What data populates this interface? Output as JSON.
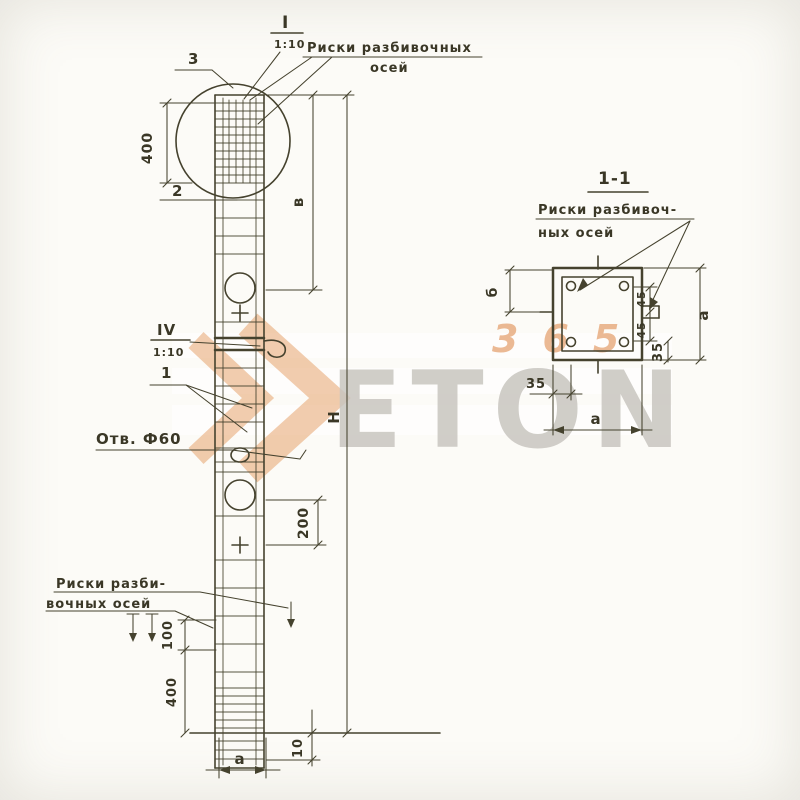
{
  "palette": {
    "ink": "#45422e",
    "orange": "#dd8340",
    "letters_gray": "#c9c6c0"
  },
  "elevation": {
    "callout_top": "3",
    "callout_upper": "2",
    "callout_mid": "1",
    "detail_top": {
      "numeral": "I",
      "scale": "1:10"
    },
    "detail_mid": {
      "numeral": "IV",
      "scale": "1:10"
    },
    "riski_top": {
      "line1": "Риски разбивочных",
      "line2": "осей"
    },
    "riski_bottom": {
      "line1": "Риски разби-",
      "line2": "вочных осей"
    },
    "hole_label": "Отв. Ф60",
    "dim_top_400": "400",
    "dim_v": "в",
    "dim_H": "Н",
    "dim_200": "200",
    "dim_100": "100",
    "dim_bottom_400": "400",
    "dim_width_a": "а",
    "dim_10": "10"
  },
  "section": {
    "title": "1-1",
    "riski": {
      "line1": "Риски разбивоч-",
      "line2": "ных осей"
    },
    "dim_left_b": "б",
    "dim_right_45a": "45",
    "dim_right_45b": "45",
    "dim_right_35": "35",
    "dim_right_a": "а",
    "dim_bottom_35": "35",
    "dim_bottom_a": "а"
  },
  "watermark": {
    "letters": "ETON",
    "digits": "365"
  }
}
